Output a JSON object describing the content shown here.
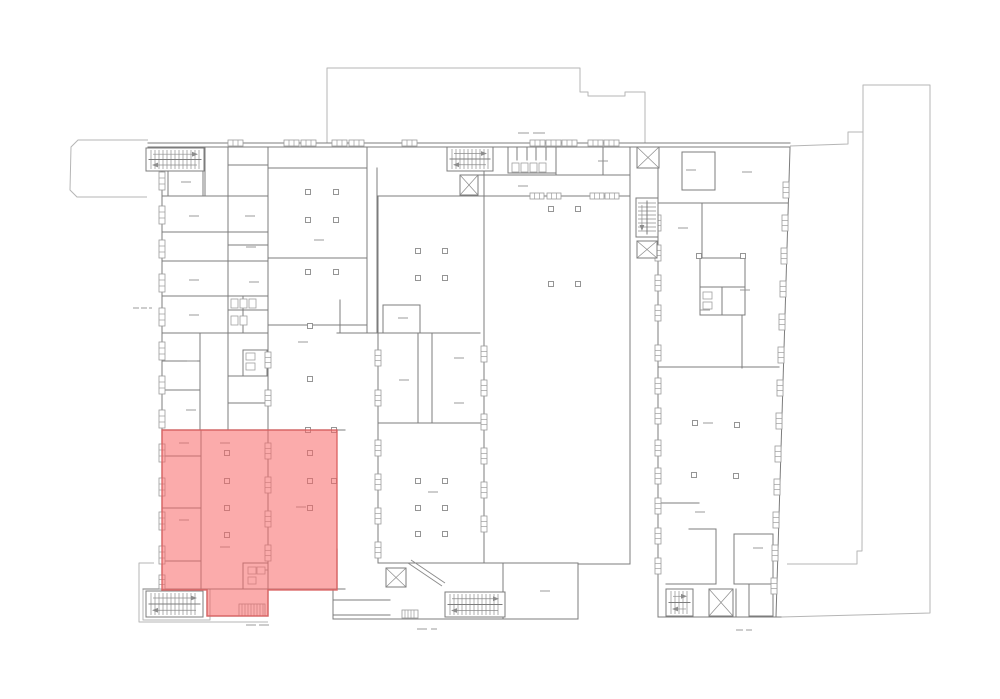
{
  "app": {
    "type": "cad-floor-plan-view",
    "background": "#ffffff"
  },
  "canvas": {
    "w": 1000,
    "h": 699
  },
  "palette": {
    "wall": "#7c7c7c",
    "outline": "#b5b5b5",
    "window": "#9b9b9b",
    "highlight_fill": "#f76666",
    "highlight_fill_opacity": 0.55,
    "highlight_stroke": "#d95f5f",
    "highlight_stroke_opacity": 0.85
  },
  "highlight": {
    "id": "selected-area",
    "points": [
      [
        162,
        430
      ],
      [
        337,
        430
      ],
      [
        337,
        590
      ],
      [
        268,
        590
      ],
      [
        268,
        616
      ],
      [
        207,
        616
      ],
      [
        207,
        590
      ],
      [
        162,
        590
      ]
    ]
  },
  "outlines": [
    [
      [
        327,
        143
      ],
      [
        327,
        68
      ],
      [
        580,
        68
      ],
      [
        580,
        92
      ],
      [
        588,
        92
      ],
      [
        588,
        96
      ],
      [
        625,
        96
      ],
      [
        625,
        92
      ],
      [
        645,
        92
      ],
      [
        645,
        143
      ]
    ],
    [
      [
        790,
        146
      ],
      [
        848,
        144
      ],
      [
        848,
        132
      ],
      [
        863,
        132
      ],
      [
        863,
        85
      ],
      [
        930,
        85
      ],
      [
        930,
        613
      ],
      [
        781,
        617
      ]
    ],
    [
      [
        863,
        132
      ],
      [
        862,
        551
      ],
      [
        857,
        551
      ],
      [
        857,
        564
      ],
      [
        787,
        564
      ]
    ],
    [
      [
        148,
        140
      ],
      [
        78,
        140
      ],
      [
        71,
        147
      ],
      [
        70,
        190
      ],
      [
        77,
        197
      ],
      [
        147,
        197
      ]
    ],
    [
      [
        154,
        563
      ],
      [
        139,
        563
      ],
      [
        139,
        622
      ],
      [
        268,
        622
      ]
    ],
    [
      [
        143,
        589
      ],
      [
        143,
        620
      ],
      [
        210,
        620
      ],
      [
        210,
        589
      ]
    ]
  ],
  "walls": [
    [
      148,
      143,
      790,
      143
    ],
    [
      148,
      147,
      790,
      147
    ],
    [
      162,
      148,
      162,
      591
    ],
    [
      143,
      589,
      345,
      589
    ],
    [
      630,
      148,
      630,
      564
    ],
    [
      578,
      564,
      630,
      564
    ],
    [
      578,
      564,
      578,
      619
    ],
    [
      333,
      619,
      578,
      619
    ],
    [
      333,
      589,
      333,
      619
    ],
    [
      205,
      148,
      205,
      196
    ],
    [
      162,
      196,
      268,
      196
    ],
    [
      228,
      148,
      228,
      430
    ],
    [
      228,
      165,
      268,
      165
    ],
    [
      162,
      232,
      268,
      232
    ],
    [
      162,
      261,
      268,
      261
    ],
    [
      162,
      296,
      268,
      296
    ],
    [
      162,
      333,
      268,
      333
    ],
    [
      243,
      296,
      243,
      333
    ],
    [
      228,
      245,
      268,
      245
    ],
    [
      228,
      310,
      268,
      310
    ],
    [
      200,
      333,
      200,
      430
    ],
    [
      162,
      361,
      200,
      361
    ],
    [
      162,
      390,
      200,
      390
    ],
    [
      228,
      376,
      268,
      376
    ],
    [
      228,
      403,
      268,
      403
    ],
    [
      162,
      430,
      345,
      430
    ],
    [
      201,
      430,
      201,
      589
    ],
    [
      162,
      456,
      201,
      456
    ],
    [
      162,
      508,
      201,
      508
    ],
    [
      162,
      561,
      201,
      561
    ],
    [
      243,
      563,
      268,
      563
    ],
    [
      243,
      563,
      243,
      589
    ],
    [
      207,
      590,
      207,
      616
    ],
    [
      207,
      616,
      268,
      616
    ],
    [
      268,
      589,
      268,
      616
    ],
    [
      268,
      148,
      268,
      589
    ],
    [
      268,
      168,
      367,
      168
    ],
    [
      268,
      258,
      367,
      258
    ],
    [
      268,
      325,
      367,
      325
    ],
    [
      367,
      148,
      367,
      333
    ],
    [
      377,
      168,
      377,
      333
    ],
    [
      340,
      300,
      340,
      333
    ],
    [
      337,
      549,
      337,
      589
    ],
    [
      337,
      333,
      480,
      333
    ],
    [
      378,
      196,
      378,
      563
    ],
    [
      484,
      148,
      484,
      563
    ],
    [
      378,
      196,
      630,
      196
    ],
    [
      418,
      333,
      418,
      423
    ],
    [
      432,
      333,
      432,
      423
    ],
    [
      378,
      423,
      484,
      423
    ],
    [
      378,
      563,
      503,
      563
    ],
    [
      503,
      563,
      503,
      619
    ],
    [
      333,
      600,
      390,
      600
    ],
    [
      333,
      615,
      390,
      615
    ],
    [
      477,
      175,
      630,
      175
    ],
    [
      517,
      147,
      517,
      160
    ],
    [
      527,
      147,
      527,
      160
    ],
    [
      536,
      147,
      536,
      160
    ],
    [
      546,
      147,
      546,
      160
    ],
    [
      556,
      148,
      556,
      175
    ],
    [
      603,
      148,
      603,
      175
    ],
    [
      658,
      148,
      658,
      617
    ],
    [
      790,
      148,
      776,
      617
    ],
    [
      658,
      203,
      788,
      203
    ],
    [
      702,
      203,
      702,
      257
    ],
    [
      742,
      316,
      742,
      368
    ],
    [
      658,
      367,
      779,
      367
    ],
    [
      658,
      503,
      699,
      503
    ],
    [
      689,
      529,
      716,
      529
    ],
    [
      716,
      529,
      716,
      584
    ],
    [
      666,
      584,
      716,
      584
    ],
    [
      658,
      617,
      781,
      617
    ],
    [
      736,
      589,
      736,
      616
    ],
    [
      700,
      287,
      745,
      287
    ],
    [
      722,
      287,
      722,
      315
    ]
  ],
  "boxes": [
    [
      168,
      152,
      35,
      44
    ],
    [
      682,
      152,
      33,
      38
    ],
    [
      700,
      258,
      45,
      57
    ],
    [
      734,
      534,
      39,
      50
    ],
    [
      749,
      584,
      24,
      32
    ],
    [
      383,
      305,
      37,
      28
    ],
    [
      243,
      350,
      24,
      26
    ],
    [
      503,
      563,
      75,
      56
    ],
    [
      508,
      147,
      48,
      26
    ]
  ],
  "windows": [
    [
      "v",
      162,
      172,
      18
    ],
    [
      "v",
      162,
      206,
      18
    ],
    [
      "v",
      162,
      240,
      18
    ],
    [
      "v",
      162,
      274,
      18
    ],
    [
      "v",
      162,
      308,
      18
    ],
    [
      "v",
      162,
      342,
      18
    ],
    [
      "v",
      162,
      376,
      18
    ],
    [
      "v",
      162,
      410,
      18
    ],
    [
      "v",
      162,
      444,
      18
    ],
    [
      "v",
      162,
      478,
      18
    ],
    [
      "v",
      162,
      512,
      18
    ],
    [
      "v",
      162,
      546,
      18
    ],
    [
      "v",
      162,
      575,
      14
    ],
    [
      "v",
      268,
      352,
      16
    ],
    [
      "v",
      268,
      390,
      16
    ],
    [
      "v",
      268,
      443,
      16
    ],
    [
      "v",
      268,
      477,
      16
    ],
    [
      "v",
      268,
      511,
      16
    ],
    [
      "v",
      268,
      545,
      16
    ],
    [
      "v",
      378,
      350,
      16
    ],
    [
      "v",
      378,
      390,
      16
    ],
    [
      "v",
      378,
      440,
      16
    ],
    [
      "v",
      378,
      474,
      16
    ],
    [
      "v",
      378,
      508,
      16
    ],
    [
      "v",
      378,
      542,
      16
    ],
    [
      "v",
      484,
      346,
      16
    ],
    [
      "v",
      484,
      380,
      16
    ],
    [
      "v",
      484,
      414,
      16
    ],
    [
      "v",
      484,
      448,
      16
    ],
    [
      "v",
      484,
      482,
      16
    ],
    [
      "v",
      484,
      516,
      16
    ],
    [
      "v",
      658,
      215,
      16
    ],
    [
      "v",
      658,
      245,
      16
    ],
    [
      "v",
      658,
      275,
      16
    ],
    [
      "v",
      658,
      305,
      16
    ],
    [
      "v",
      658,
      345,
      16
    ],
    [
      "v",
      658,
      378,
      16
    ],
    [
      "v",
      658,
      408,
      16
    ],
    [
      "v",
      658,
      440,
      16
    ],
    [
      "v",
      658,
      468,
      16
    ],
    [
      "v",
      658,
      498,
      16
    ],
    [
      "v",
      658,
      528,
      16
    ],
    [
      "v",
      658,
      558,
      16
    ],
    [
      "v",
      786,
      182,
      16
    ],
    [
      "v",
      785,
      215,
      16
    ],
    [
      "v",
      784,
      248,
      16
    ],
    [
      "v",
      783,
      281,
      16
    ],
    [
      "v",
      782,
      314,
      16
    ],
    [
      "v",
      781,
      347,
      16
    ],
    [
      "v",
      780,
      380,
      16
    ],
    [
      "v",
      779,
      413,
      16
    ],
    [
      "v",
      778,
      446,
      16
    ],
    [
      "v",
      777,
      479,
      16
    ],
    [
      "v",
      776,
      512,
      16
    ],
    [
      "v",
      775,
      545,
      16
    ],
    [
      "v",
      774,
      578,
      16
    ],
    [
      "h",
      228,
      143,
      15
    ],
    [
      "h",
      284,
      143,
      15
    ],
    [
      "h",
      301,
      143,
      15
    ],
    [
      "h",
      332,
      143,
      15
    ],
    [
      "h",
      349,
      143,
      15
    ],
    [
      "h",
      402,
      143,
      15
    ],
    [
      "h",
      530,
      143,
      15
    ],
    [
      "h",
      546,
      143,
      15
    ],
    [
      "h",
      562,
      143,
      15
    ],
    [
      "h",
      588,
      143,
      15
    ],
    [
      "h",
      604,
      143,
      15
    ],
    [
      "h",
      530,
      196,
      14
    ],
    [
      "h",
      547,
      196,
      14
    ],
    [
      "h",
      590,
      196,
      14
    ],
    [
      "h",
      605,
      196,
      14
    ]
  ],
  "stairs": [
    [
      146,
      148,
      58,
      23,
      "h"
    ],
    [
      447,
      147,
      46,
      24,
      "h"
    ],
    [
      636,
      198,
      22,
      39,
      "v"
    ],
    [
      146,
      591,
      57,
      26,
      "h"
    ],
    [
      445,
      592,
      60,
      25,
      "h"
    ],
    [
      666,
      589,
      27,
      27,
      "h"
    ]
  ],
  "elevators": [
    [
      637,
      147,
      22,
      21
    ],
    [
      460,
      175,
      18,
      20
    ],
    [
      386,
      568,
      20,
      19
    ],
    [
      709,
      589,
      24,
      27
    ],
    [
      637,
      241,
      20,
      17
    ]
  ],
  "steps": [
    [
      239,
      604,
      26,
      12
    ],
    [
      402,
      610,
      16,
      8
    ]
  ],
  "columns": [
    [
      308,
      192
    ],
    [
      336,
      192
    ],
    [
      308,
      220
    ],
    [
      336,
      220
    ],
    [
      308,
      272
    ],
    [
      336,
      272
    ],
    [
      310,
      326
    ],
    [
      310,
      379
    ],
    [
      308,
      430
    ],
    [
      334,
      430
    ],
    [
      227,
      453
    ],
    [
      227,
      481
    ],
    [
      227,
      508
    ],
    [
      227,
      535
    ],
    [
      310,
      453
    ],
    [
      310,
      481
    ],
    [
      310,
      508
    ],
    [
      334,
      481
    ],
    [
      418,
      251
    ],
    [
      445,
      251
    ],
    [
      418,
      278
    ],
    [
      445,
      278
    ],
    [
      418,
      481
    ],
    [
      445,
      481
    ],
    [
      418,
      508
    ],
    [
      445,
      508
    ],
    [
      418,
      534
    ],
    [
      445,
      534
    ],
    [
      551,
      209
    ],
    [
      578,
      209
    ],
    [
      551,
      284
    ],
    [
      578,
      284
    ],
    [
      695,
      423
    ],
    [
      737,
      425
    ],
    [
      694,
      475
    ],
    [
      736,
      476
    ],
    [
      699,
      256
    ],
    [
      743,
      256
    ]
  ],
  "labels": [
    [
      181,
      182
    ],
    [
      189,
      216
    ],
    [
      189,
      280
    ],
    [
      189,
      315
    ],
    [
      187,
      361
    ],
    [
      186,
      410
    ],
    [
      245,
      216
    ],
    [
      246,
      247
    ],
    [
      249,
      282
    ],
    [
      179,
      443
    ],
    [
      179,
      520
    ],
    [
      220,
      443
    ],
    [
      220,
      547
    ],
    [
      296,
      507
    ],
    [
      258,
      570
    ],
    [
      314,
      240
    ],
    [
      298,
      342
    ],
    [
      398,
      318
    ],
    [
      454,
      358
    ],
    [
      399,
      380
    ],
    [
      454,
      403
    ],
    [
      428,
      492
    ],
    [
      518,
      186
    ],
    [
      598,
      161
    ],
    [
      540,
      591
    ],
    [
      686,
      170
    ],
    [
      742,
      172
    ],
    [
      678,
      228
    ],
    [
      740,
      290
    ],
    [
      700,
      310
    ],
    [
      703,
      423
    ],
    [
      695,
      512
    ],
    [
      753,
      548
    ]
  ],
  "fixtures": [
    [
      512,
      163,
      7,
      9
    ],
    [
      521,
      163,
      7,
      9
    ],
    [
      530,
      163,
      7,
      9
    ],
    [
      539,
      163,
      7,
      9
    ],
    [
      231,
      299,
      7,
      9
    ],
    [
      240,
      299,
      7,
      9
    ],
    [
      249,
      299,
      7,
      9
    ],
    [
      231,
      316,
      7,
      9
    ],
    [
      240,
      316,
      7,
      9
    ],
    [
      246,
      353,
      9,
      7
    ],
    [
      246,
      363,
      9,
      7
    ],
    [
      703,
      292,
      9,
      7
    ],
    [
      703,
      302,
      9,
      7
    ],
    [
      248,
      567,
      8,
      7
    ],
    [
      257,
      567,
      8,
      7
    ],
    [
      248,
      577,
      8,
      7
    ]
  ],
  "diagonals": [
    [
      408,
      563,
      442,
      586
    ],
    [
      411,
      560,
      445,
      583
    ]
  ],
  "dashes": [
    [
      518,
      133,
      529,
      133
    ],
    [
      533,
      133,
      545,
      133
    ],
    [
      133,
      308,
      139,
      308
    ],
    [
      141,
      308,
      147,
      308
    ],
    [
      149,
      308,
      152,
      308
    ],
    [
      417,
      629,
      427,
      629
    ],
    [
      431,
      629,
      437,
      629
    ],
    [
      246,
      625,
      256,
      625
    ],
    [
      259,
      625,
      269,
      625
    ],
    [
      736,
      630,
      743,
      630
    ],
    [
      746,
      630,
      752,
      630
    ]
  ]
}
